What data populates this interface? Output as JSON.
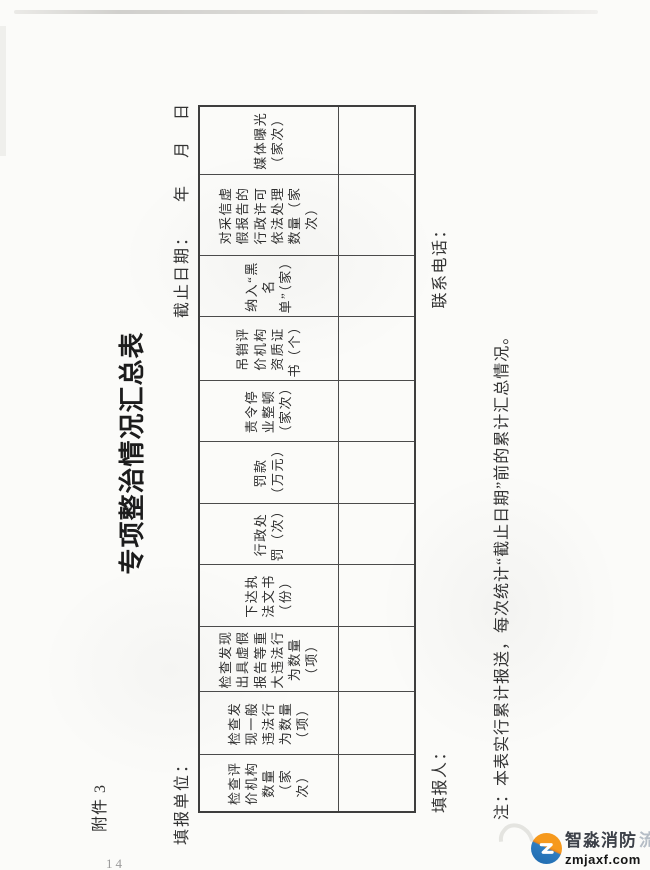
{
  "page": {
    "attachment_label": "附件 3",
    "title": "专项整治情况汇总表",
    "fill_unit_label": "填报单位：",
    "deadline_label": "截止日期：",
    "year_label": "年",
    "month_label": "月",
    "day_label": "日",
    "filler_label": "填报人：",
    "phone_label": "联系电话：",
    "note": "注：本表实行累计报送，每次统计“截止日期”前的累计汇总情况。",
    "page_number": "14"
  },
  "table": {
    "columns": [
      {
        "label": "检查评价机构数量（家次）",
        "value": ""
      },
      {
        "label": "检查发现一般违法行为数量（项）",
        "value": ""
      },
      {
        "label": "检查发现出具虚假报告等重大违法行为数量（项）",
        "value": ""
      },
      {
        "label": "下达执法文书（份）",
        "value": ""
      },
      {
        "label": "行政处罚（次）",
        "value": ""
      },
      {
        "label": "罚款（万元）",
        "value": ""
      },
      {
        "label": "责令停业整顿（家次）",
        "value": ""
      },
      {
        "label": "吊销评价机构资质证书（个）",
        "value": ""
      },
      {
        "label": "纳入“黑名单”（家）",
        "value": ""
      },
      {
        "label": "对采信虚假报告的行政许可依法处理数量（家次）",
        "value": ""
      },
      {
        "label": "媒体曝光（家次）",
        "value": ""
      }
    ]
  },
  "watermark": {
    "brand": "智淼消防",
    "brand_suffix": "流",
    "domain": "zmjaxf.com",
    "logo_icon": "z-swoosh-icon"
  },
  "colors": {
    "logo_orange": "#f6991d",
    "logo_blue": "#1f69ad",
    "border_dark": "#3e3e3e"
  }
}
